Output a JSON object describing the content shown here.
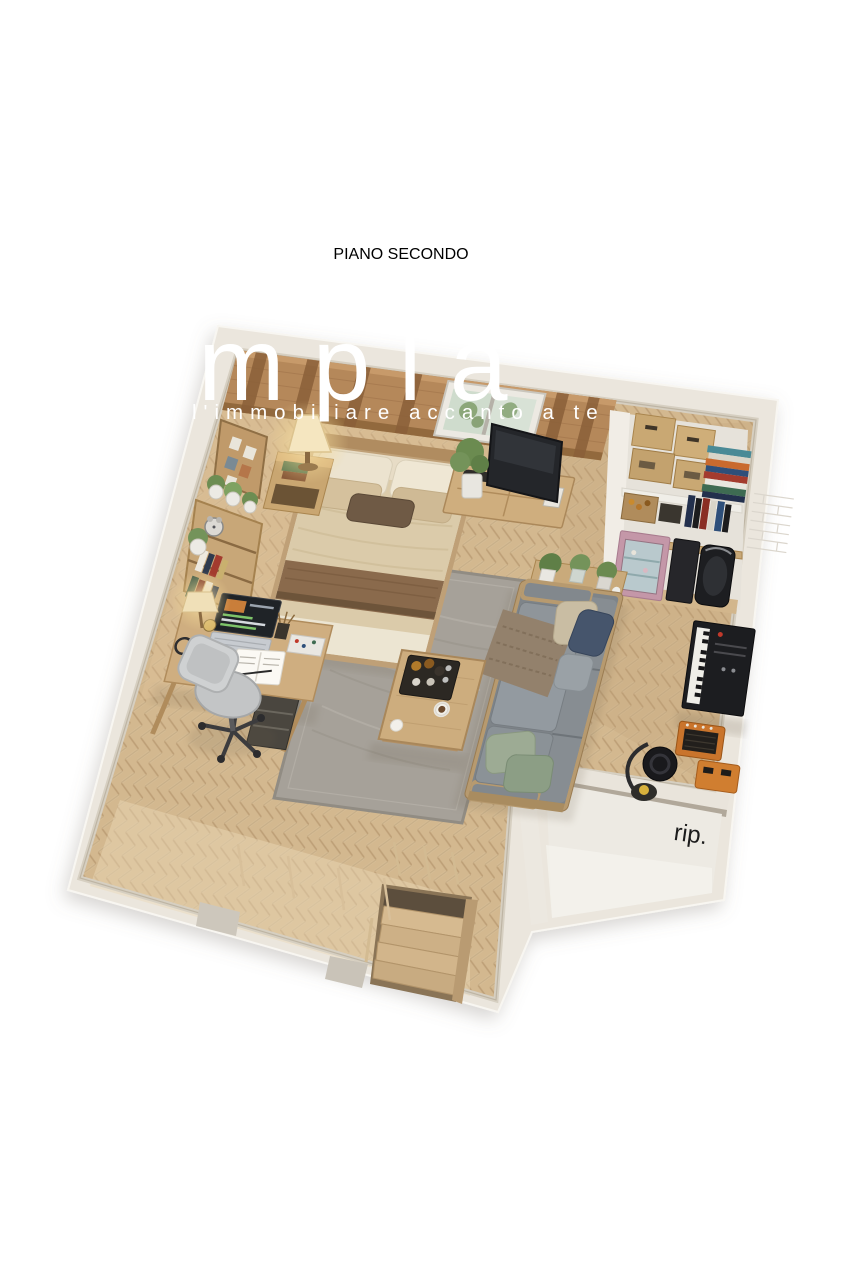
{
  "title": {
    "text": "PIANO SECONDO"
  },
  "watermark": {
    "brand": "mpla",
    "tagline": "l'immobiliare accanto a te",
    "color": "#ffffff"
  },
  "labels": {
    "storage_room": "rip."
  },
  "scene": {
    "type": "3d-floor-plan-render",
    "floor_label": "PIANO SECONDO",
    "rooms": [
      "open-studio-bedroom-living",
      "storage-room-rip"
    ],
    "furniture": [
      "double-bed",
      "nightstand",
      "table-lamp",
      "corkboard",
      "plant-shelf",
      "bookshelf",
      "desk",
      "laptop",
      "desk-lamp",
      "office-chair",
      "area-rug",
      "coffee-table",
      "sofa",
      "plant-console",
      "tv-console",
      "tv",
      "skylight-window",
      "storage-closet",
      "cardboard-boxes",
      "books",
      "pink-display-cabinet",
      "speaker-cases",
      "digital-piano",
      "guitar-amp",
      "vacuum-cleaner",
      "staircase"
    ]
  },
  "palette": {
    "background": "#ffffff",
    "walls": "#ebe6dd",
    "wall_shadow": "#cfc8ba",
    "floor_wood": "#d5ba93",
    "floor_seam": "#b3966d",
    "ceiling_wood": "#b5885a",
    "rug": "#a6a199",
    "sofa_gray": "#868c91",
    "bed_duvet": "#dccdb2",
    "throw_brown": "#8a6b4d",
    "desk_wood": "#cfae80",
    "piano_black": "#1c1d20",
    "cabinet_pink": "#c497a8",
    "amp_orange": "#c9742c",
    "plant_green": "#6b8b50",
    "navy_pillow": "#46556c",
    "title_text": "#1c1c1c"
  }
}
